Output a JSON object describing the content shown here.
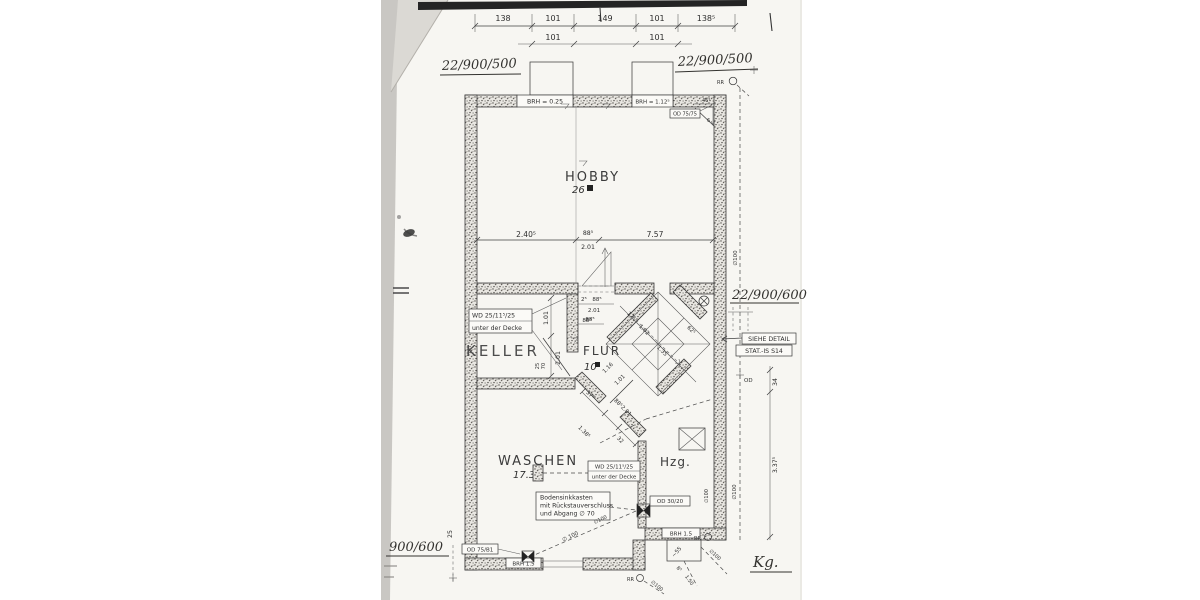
{
  "plan": {
    "rooms": {
      "hobby": {
        "name": "HOBBY",
        "area": "26"
      },
      "keller": {
        "name": "KELLER"
      },
      "flur": {
        "name": "FLUR",
        "area": "10"
      },
      "waschen": {
        "name": "WASCHEN",
        "area": "17.3"
      },
      "hzg": {
        "name": "Hzg."
      }
    },
    "handwritten": {
      "top_left": "22/900/500",
      "top_right": "22/900/500",
      "right": "22/900/600",
      "bottom_left": "900/600",
      "sheet": "Kg."
    },
    "top_dims": {
      "row1": [
        "138",
        "101",
        "149",
        "101",
        "138⁵"
      ],
      "row2": [
        "101",
        "101"
      ]
    },
    "hobby_dims": {
      "left": "2.40⁵",
      "door_w": "88⁵",
      "door_h": "2.01",
      "right": "7.57"
    },
    "door_top": {
      "a": "2⁵",
      "b": "88⁵",
      "c": "2.01",
      "d": "88⁵"
    },
    "keller_dims": {
      "h1": "1.01",
      "h2": "2.01",
      "t1": "70",
      "t2": "25",
      "door": "88⁵"
    },
    "stair_dims": {
      "a": "1.02",
      "b": "1.35",
      "c": "62⁵",
      "d": "17⁵",
      "e": "1.16",
      "f": "1.01"
    },
    "chamfer_dims": {
      "a": "37⁵",
      "b": "88⁵",
      "c": "2.01",
      "d": "1.38⁵",
      "e": "32"
    },
    "right_dims": {
      "a": "34",
      "b": "3.37⁵",
      "od": "OD",
      "pipe": "∅100"
    },
    "corner_dims": {
      "a": "46⁵",
      "b": "6"
    },
    "bottom_dims": {
      "k25": "25",
      "pipe_a": "∅ 100",
      "pipe_b": "∅100",
      "lw": "~55",
      "lw2": "8⁵",
      "lw3": "1.50"
    },
    "labels": {
      "brh_left": "BRH = 0.25",
      "brh_right": "BRH = 1.12⁵",
      "wd1_l1": "WD 25/11⁵/25",
      "wd1_l2": "unter der Decke",
      "wd2_l1": "WD 25/11⁵/25",
      "wd2_l2": "unter der Decke",
      "sink_l1": "Bodensinkkasten",
      "sink_l2": "mit Rückstauverschluss",
      "sink_l3": "und Abgang ∅ 70",
      "od_corner": "OD 75/75",
      "od_drain": "OD 30/20",
      "od_bottom": "OD 75/B1",
      "brh_bottom": "BRH 1.5",
      "brh_hzg": "BRH 1.5",
      "detail1": "SIEHE DETAIL",
      "detail2": "STAT.-IS S14",
      "rr": "RR"
    }
  }
}
